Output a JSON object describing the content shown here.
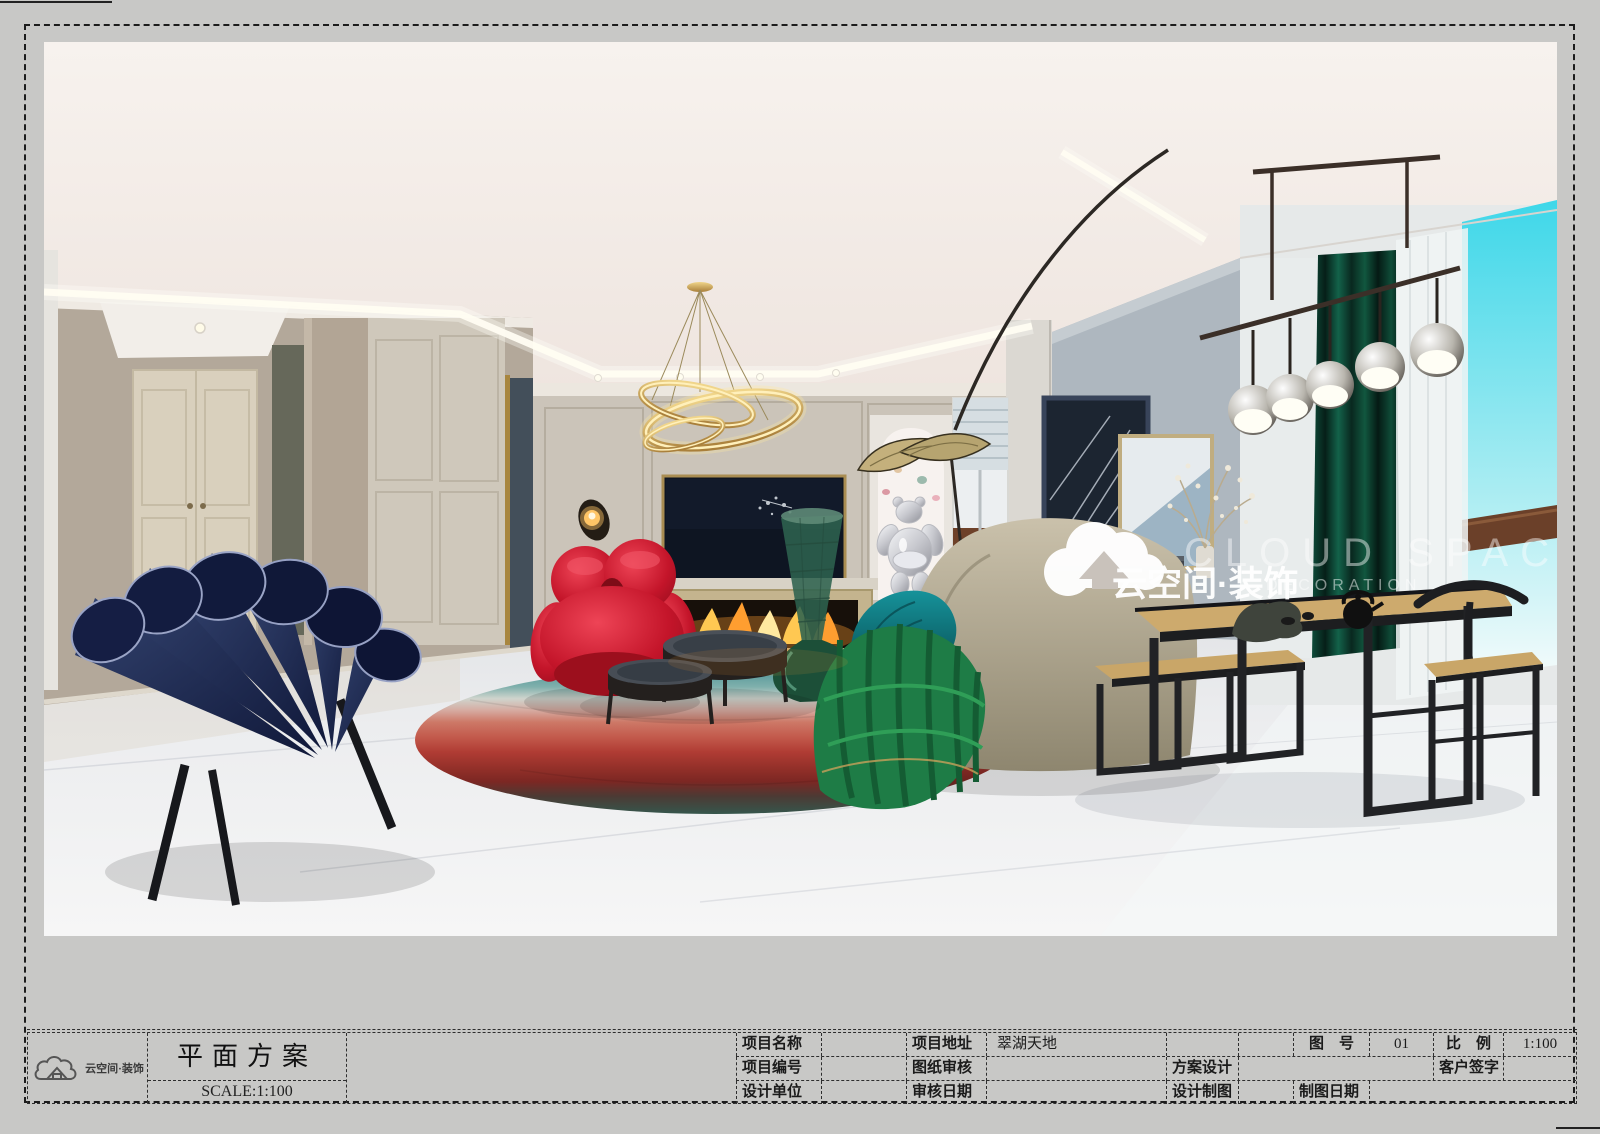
{
  "sheet": {
    "drawing_title": "平面方案",
    "scale_label": "SCALE:1:100",
    "brand": {
      "name_cn": "云空间·装饰",
      "logo": "cloud-house-logo"
    }
  },
  "title_block": {
    "r1": [
      "项目名称",
      "",
      "项目地址",
      "翠湖天地",
      "",
      "",
      "图　号",
      "01",
      "比　例",
      "1:100"
    ],
    "r2": [
      "项目编号",
      "",
      "图纸审核",
      "",
      "方案设计",
      "",
      "客户签字",
      ""
    ],
    "r3": [
      "设计单位",
      "",
      "审核日期",
      "",
      "设计制图",
      "",
      "制图日期",
      ""
    ]
  },
  "watermark": {
    "name_cn": "云空间·装饰",
    "en_line1": "CLOUD SPACE",
    "en_line2": "DECORATION"
  },
  "rendering": {
    "subject": "modern living and dining room interior rendering",
    "palette": {
      "wall_taupe": "#b3a89a",
      "wall_greige": "#cbc4b9",
      "wall_blue_gray": "#aeb7bf",
      "ceiling": "#f5f0ec",
      "gold_accent": "#c9a24d",
      "red_chair": "#c4152a",
      "navy_chair": "#1c2750",
      "green_chaise": "#1e7c46",
      "emerald_curtain": "#0e4c3a",
      "sky": "#3ed7e9",
      "floor": "#eceef0",
      "wood_top": "#cdaa6d"
    }
  }
}
